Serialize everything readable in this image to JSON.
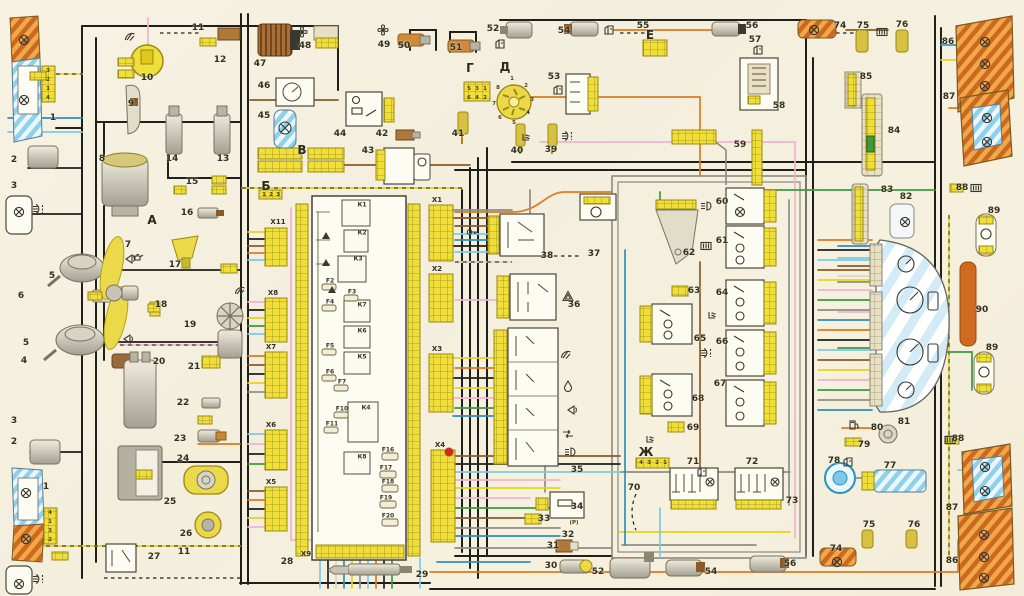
{
  "meta": {
    "type": "automotive-wiring-diagram",
    "language": "Russian",
    "numbered_components_range": "1-90"
  },
  "palette": {
    "background": "#f6f0df",
    "connector_yellow": "#f0df3a",
    "connector_border": "#9a8a10",
    "headlight_blue_hatch": "#8fd0ea",
    "tail_lamp_orange": "#f0a848",
    "tail_lamp_orange_dark": "#cc6820",
    "wire_black": "#1f1f1c",
    "wire_pink": "#efb3cf",
    "wire_orange": "#de7a1c",
    "wire_yellow": "#e6d31f",
    "wire_blue": "#2e8fc0",
    "wire_lightblue": "#7cc9e8",
    "wire_green": "#3c9a3f",
    "wire_brown": "#8a5a28",
    "wire_gray": "#8e8e84",
    "metal": "#c9c4b2",
    "block_fill": "#fdfcf2",
    "marker_red": "#cc2a22"
  },
  "labels": {
    "numbers": [
      {
        "t": "1",
        "x": 53,
        "y": 118
      },
      {
        "t": "2",
        "x": 14,
        "y": 160
      },
      {
        "t": "3",
        "x": 14,
        "y": 186
      },
      {
        "t": "4",
        "x": 24,
        "y": 361
      },
      {
        "t": "5",
        "x": 52,
        "y": 276
      },
      {
        "t": "5",
        "x": 26,
        "y": 343
      },
      {
        "t": "6",
        "x": 21,
        "y": 296
      },
      {
        "t": "7",
        "x": 128,
        "y": 245
      },
      {
        "t": "8",
        "x": 102,
        "y": 159
      },
      {
        "t": "9",
        "x": 131,
        "y": 104
      },
      {
        "t": "10",
        "x": 147,
        "y": 78
      },
      {
        "t": "11",
        "x": 198,
        "y": 28
      },
      {
        "t": "12",
        "x": 220,
        "y": 60
      },
      {
        "t": "13",
        "x": 223,
        "y": 159
      },
      {
        "t": "14",
        "x": 172,
        "y": 159
      },
      {
        "t": "15",
        "x": 192,
        "y": 182
      },
      {
        "t": "16",
        "x": 187,
        "y": 213
      },
      {
        "t": "17",
        "x": 175,
        "y": 265
      },
      {
        "t": "18",
        "x": 161,
        "y": 305
      },
      {
        "t": "19",
        "x": 190,
        "y": 325
      },
      {
        "t": "20",
        "x": 159,
        "y": 362
      },
      {
        "t": "21",
        "x": 194,
        "y": 367
      },
      {
        "t": "22",
        "x": 183,
        "y": 403
      },
      {
        "t": "23",
        "x": 180,
        "y": 439
      },
      {
        "t": "24",
        "x": 183,
        "y": 459
      },
      {
        "t": "25",
        "x": 170,
        "y": 502
      },
      {
        "t": "26",
        "x": 186,
        "y": 534
      },
      {
        "t": "27",
        "x": 154,
        "y": 557
      },
      {
        "t": "1",
        "x": 46,
        "y": 487
      },
      {
        "t": "2",
        "x": 14,
        "y": 442
      },
      {
        "t": "3",
        "x": 14,
        "y": 421
      },
      {
        "t": "11",
        "x": 184,
        "y": 552
      },
      {
        "t": "28",
        "x": 287,
        "y": 562
      },
      {
        "t": "29",
        "x": 422,
        "y": 575
      },
      {
        "t": "30",
        "x": 551,
        "y": 566
      },
      {
        "t": "31",
        "x": 553,
        "y": 546
      },
      {
        "t": "32",
        "x": 568,
        "y": 535
      },
      {
        "t": "33",
        "x": 544,
        "y": 519
      },
      {
        "t": "34",
        "x": 577,
        "y": 507
      },
      {
        "t": "35",
        "x": 577,
        "y": 470
      },
      {
        "t": "36",
        "x": 574,
        "y": 305
      },
      {
        "t": "37",
        "x": 594,
        "y": 254
      },
      {
        "t": "38",
        "x": 547,
        "y": 256
      },
      {
        "t": "39",
        "x": 551,
        "y": 150
      },
      {
        "t": "40",
        "x": 517,
        "y": 151
      },
      {
        "t": "41",
        "x": 458,
        "y": 134
      },
      {
        "t": "42",
        "x": 382,
        "y": 134
      },
      {
        "t": "43",
        "x": 368,
        "y": 151
      },
      {
        "t": "44",
        "x": 340,
        "y": 134
      },
      {
        "t": "45",
        "x": 264,
        "y": 116
      },
      {
        "t": "46",
        "x": 264,
        "y": 86
      },
      {
        "t": "47",
        "x": 260,
        "y": 64
      },
      {
        "t": "48",
        "x": 305,
        "y": 46
      },
      {
        "t": "49",
        "x": 384,
        "y": 45
      },
      {
        "t": "50",
        "x": 404,
        "y": 46
      },
      {
        "t": "51",
        "x": 456,
        "y": 48
      },
      {
        "t": "52",
        "x": 493,
        "y": 29
      },
      {
        "t": "53",
        "x": 554,
        "y": 77
      },
      {
        "t": "54",
        "x": 564,
        "y": 31
      },
      {
        "t": "55",
        "x": 643,
        "y": 26
      },
      {
        "t": "56",
        "x": 752,
        "y": 26
      },
      {
        "t": "57",
        "x": 755,
        "y": 40
      },
      {
        "t": "58",
        "x": 779,
        "y": 106
      },
      {
        "t": "59",
        "x": 740,
        "y": 145
      },
      {
        "t": "60",
        "x": 722,
        "y": 202
      },
      {
        "t": "61",
        "x": 722,
        "y": 241
      },
      {
        "t": "62",
        "x": 689,
        "y": 253
      },
      {
        "t": "63",
        "x": 694,
        "y": 291
      },
      {
        "t": "64",
        "x": 722,
        "y": 293
      },
      {
        "t": "65",
        "x": 700,
        "y": 339
      },
      {
        "t": "66",
        "x": 722,
        "y": 342
      },
      {
        "t": "67",
        "x": 720,
        "y": 384
      },
      {
        "t": "68",
        "x": 698,
        "y": 399
      },
      {
        "t": "69",
        "x": 693,
        "y": 428
      },
      {
        "t": "70",
        "x": 634,
        "y": 488
      },
      {
        "t": "71",
        "x": 693,
        "y": 462
      },
      {
        "t": "72",
        "x": 752,
        "y": 462
      },
      {
        "t": "73",
        "x": 792,
        "y": 501
      },
      {
        "t": "74",
        "x": 840,
        "y": 26
      },
      {
        "t": "75",
        "x": 863,
        "y": 26
      },
      {
        "t": "76",
        "x": 902,
        "y": 25
      },
      {
        "t": "77",
        "x": 890,
        "y": 466
      },
      {
        "t": "78",
        "x": 834,
        "y": 461
      },
      {
        "t": "79",
        "x": 864,
        "y": 445
      },
      {
        "t": "80",
        "x": 877,
        "y": 428
      },
      {
        "t": "81",
        "x": 904,
        "y": 422
      },
      {
        "t": "82",
        "x": 906,
        "y": 197
      },
      {
        "t": "83",
        "x": 887,
        "y": 190
      },
      {
        "t": "84",
        "x": 894,
        "y": 131
      },
      {
        "t": "85",
        "x": 866,
        "y": 77
      },
      {
        "t": "86",
        "x": 948,
        "y": 42
      },
      {
        "t": "87",
        "x": 949,
        "y": 97
      },
      {
        "t": "88",
        "x": 962,
        "y": 188
      },
      {
        "t": "89",
        "x": 994,
        "y": 211
      },
      {
        "t": "90",
        "x": 982,
        "y": 310
      },
      {
        "t": "89",
        "x": 992,
        "y": 348
      },
      {
        "t": "88",
        "x": 958,
        "y": 439
      },
      {
        "t": "87",
        "x": 952,
        "y": 508
      },
      {
        "t": "86",
        "x": 952,
        "y": 561
      },
      {
        "t": "74",
        "x": 836,
        "y": 549
      },
      {
        "t": "75",
        "x": 869,
        "y": 525
      },
      {
        "t": "76",
        "x": 914,
        "y": 525
      },
      {
        "t": "52",
        "x": 598,
        "y": 572
      },
      {
        "t": "54",
        "x": 711,
        "y": 572
      },
      {
        "t": "56",
        "x": 790,
        "y": 564
      }
    ],
    "letters": [
      {
        "t": "А",
        "x": 152,
        "y": 220
      },
      {
        "t": "Б",
        "x": 266,
        "y": 186
      },
      {
        "t": "В",
        "x": 302,
        "y": 150
      },
      {
        "t": "Г",
        "x": 470,
        "y": 68
      },
      {
        "t": "Д",
        "x": 505,
        "y": 67
      },
      {
        "t": "Е",
        "x": 650,
        "y": 35
      },
      {
        "t": "Ж",
        "x": 646,
        "y": 452
      }
    ],
    "relays": [
      {
        "t": "К1",
        "x": 362,
        "y": 205
      },
      {
        "t": "К2",
        "x": 362,
        "y": 233
      },
      {
        "t": "К3",
        "x": 358,
        "y": 259
      },
      {
        "t": "К7",
        "x": 362,
        "y": 305
      },
      {
        "t": "К6",
        "x": 362,
        "y": 331
      },
      {
        "t": "К5",
        "x": 362,
        "y": 357
      },
      {
        "t": "К4",
        "x": 366,
        "y": 408
      },
      {
        "t": "К8",
        "x": 362,
        "y": 457
      }
    ],
    "fuses": [
      {
        "t": "F2",
        "x": 330,
        "y": 281
      },
      {
        "t": "F3",
        "x": 352,
        "y": 292
      },
      {
        "t": "F4",
        "x": 330,
        "y": 302
      },
      {
        "t": "F5",
        "x": 330,
        "y": 346
      },
      {
        "t": "F6",
        "x": 330,
        "y": 372
      },
      {
        "t": "F7",
        "x": 342,
        "y": 382
      },
      {
        "t": "F10",
        "x": 342,
        "y": 409
      },
      {
        "t": "F11",
        "x": 332,
        "y": 424
      },
      {
        "t": "F16",
        "x": 388,
        "y": 450
      },
      {
        "t": "F17",
        "x": 386,
        "y": 468
      },
      {
        "t": "F18",
        "x": 388,
        "y": 482
      },
      {
        "t": "F19",
        "x": 386,
        "y": 498
      },
      {
        "t": "F20",
        "x": 388,
        "y": 516
      }
    ],
    "connectors": [
      {
        "t": "Х11",
        "x": 278,
        "y": 222
      },
      {
        "t": "Х8",
        "x": 273,
        "y": 293
      },
      {
        "t": "Х7",
        "x": 271,
        "y": 347
      },
      {
        "t": "Х6",
        "x": 271,
        "y": 425
      },
      {
        "t": "Х5",
        "x": 271,
        "y": 482
      },
      {
        "t": "Х1",
        "x": 437,
        "y": 200
      },
      {
        "t": "Х2",
        "x": 437,
        "y": 269
      },
      {
        "t": "Х3",
        "x": 437,
        "y": 349
      },
      {
        "t": "Х4",
        "x": 440,
        "y": 445
      },
      {
        "t": "Х9",
        "x": 306,
        "y": 554
      }
    ],
    "pins": [
      {
        "t": "3",
        "x": 48,
        "y": 71
      },
      {
        "t": "2",
        "x": 48,
        "y": 80
      },
      {
        "t": "1",
        "x": 48,
        "y": 89
      },
      {
        "t": "4",
        "x": 48,
        "y": 98
      },
      {
        "t": "4",
        "x": 50,
        "y": 513
      },
      {
        "t": "1",
        "x": 50,
        "y": 522
      },
      {
        "t": "3",
        "x": 50,
        "y": 531
      },
      {
        "t": "2",
        "x": 50,
        "y": 540
      },
      {
        "t": "5",
        "x": 469,
        "y": 89
      },
      {
        "t": "3",
        "x": 477,
        "y": 89
      },
      {
        "t": "1",
        "x": 485,
        "y": 89
      },
      {
        "t": "6",
        "x": 469,
        "y": 98
      },
      {
        "t": "4",
        "x": 477,
        "y": 98
      },
      {
        "t": "2",
        "x": 485,
        "y": 98
      },
      {
        "t": "1",
        "x": 512,
        "y": 79
      },
      {
        "t": "2",
        "x": 526,
        "y": 86
      },
      {
        "t": "3",
        "x": 532,
        "y": 100
      },
      {
        "t": "4",
        "x": 528,
        "y": 113
      },
      {
        "t": "5",
        "x": 514,
        "y": 123
      },
      {
        "t": "6",
        "x": 500,
        "y": 118
      },
      {
        "t": "7",
        "x": 494,
        "y": 104
      },
      {
        "t": "8",
        "x": 498,
        "y": 88
      },
      {
        "t": "4",
        "x": 641,
        "y": 463
      },
      {
        "t": "3",
        "x": 649,
        "y": 463
      },
      {
        "t": "2",
        "x": 657,
        "y": 463
      },
      {
        "t": "1",
        "x": 665,
        "y": 463
      },
      {
        "t": "1",
        "x": 264,
        "y": 195
      },
      {
        "t": "2",
        "x": 271,
        "y": 195
      },
      {
        "t": "3",
        "x": 278,
        "y": 195
      },
      {
        "t": "(P)",
        "x": 574,
        "y": 523
      }
    ]
  },
  "icons": [
    {
      "type": "lamp",
      "x": 18,
      "y": 34
    },
    {
      "type": "lamp",
      "x": 18,
      "y": 94
    },
    {
      "type": "lamp",
      "x": 20,
      "y": 487
    },
    {
      "type": "lamp",
      "x": 20,
      "y": 533
    },
    {
      "type": "lamp",
      "x": 13,
      "y": 206
    },
    {
      "type": "lamp",
      "x": 13,
      "y": 578
    },
    {
      "type": "lamp",
      "x": 899,
      "y": 216
    },
    {
      "type": "lamp",
      "x": 979,
      "y": 36
    },
    {
      "type": "lamp",
      "x": 979,
      "y": 58
    },
    {
      "type": "lamp",
      "x": 979,
      "y": 80
    },
    {
      "type": "lamp",
      "x": 981,
      "y": 112
    },
    {
      "type": "lamp",
      "x": 981,
      "y": 136
    },
    {
      "type": "lamp",
      "x": 979,
      "y": 461
    },
    {
      "type": "lamp",
      "x": 979,
      "y": 485
    },
    {
      "type": "lamp",
      "x": 978,
      "y": 529
    },
    {
      "type": "lamp",
      "x": 978,
      "y": 551
    },
    {
      "type": "lamp",
      "x": 978,
      "y": 572
    },
    {
      "type": "lamp",
      "x": 808,
      "y": 24
    },
    {
      "type": "lamp",
      "x": 831,
      "y": 556
    },
    {
      "type": "fog",
      "x": 32,
      "y": 203
    },
    {
      "type": "fog",
      "x": 32,
      "y": 573
    },
    {
      "type": "fog",
      "x": 561,
      "y": 130
    },
    {
      "type": "fog",
      "x": 700,
      "y": 347
    },
    {
      "type": "horn",
      "x": 124,
      "y": 252
    },
    {
      "type": "horn",
      "x": 122,
      "y": 332
    },
    {
      "type": "horn",
      "x": 566,
      "y": 403
    },
    {
      "type": "wiper",
      "x": 124,
      "y": 30
    },
    {
      "type": "wiper",
      "x": 560,
      "y": 348
    },
    {
      "type": "wiper",
      "x": 234,
      "y": 284
    },
    {
      "type": "droplet",
      "x": 562,
      "y": 380
    },
    {
      "type": "seatheat",
      "x": 520,
      "y": 132
    },
    {
      "type": "seatheat",
      "x": 706,
      "y": 310
    },
    {
      "type": "seatheat",
      "x": 644,
      "y": 434
    },
    {
      "type": "fan4",
      "x": 296,
      "y": 26
    },
    {
      "type": "fan4",
      "x": 377,
      "y": 24
    },
    {
      "type": "key",
      "x": 466,
      "y": 226
    },
    {
      "type": "door",
      "x": 494,
      "y": 38
    },
    {
      "type": "door",
      "x": 552,
      "y": 84
    },
    {
      "type": "door",
      "x": 603,
      "y": 24
    },
    {
      "type": "door",
      "x": 752,
      "y": 44
    },
    {
      "type": "door",
      "x": 696,
      "y": 466
    },
    {
      "type": "door",
      "x": 842,
      "y": 456
    },
    {
      "type": "warntri",
      "x": 562,
      "y": 290
    },
    {
      "type": "grille",
      "x": 970,
      "y": 182
    },
    {
      "type": "grille",
      "x": 944,
      "y": 434
    },
    {
      "type": "grille",
      "x": 700,
      "y": 240
    },
    {
      "type": "grille",
      "x": 876,
      "y": 26
    },
    {
      "type": "headlamp",
      "x": 564,
      "y": 446
    },
    {
      "type": "headlamp",
      "x": 700,
      "y": 200
    },
    {
      "type": "arrows",
      "x": 562,
      "y": 428
    },
    {
      "type": "oilcan",
      "x": 132,
      "y": 250
    },
    {
      "type": "fuelpump",
      "x": 848,
      "y": 418
    }
  ],
  "mini_connectors": [
    {
      "x": 42,
      "y": 66,
      "w": 13,
      "h": 36
    },
    {
      "x": 44,
      "y": 508,
      "w": 13,
      "h": 36
    },
    {
      "x": 118,
      "y": 58,
      "w": 16,
      "h": 8
    },
    {
      "x": 118,
      "y": 70,
      "w": 16,
      "h": 8
    },
    {
      "x": 200,
      "y": 38,
      "w": 16,
      "h": 8
    },
    {
      "x": 212,
      "y": 176,
      "w": 14,
      "h": 8
    },
    {
      "x": 212,
      "y": 186,
      "w": 14,
      "h": 8
    },
    {
      "x": 174,
      "y": 186,
      "w": 12,
      "h": 8
    },
    {
      "x": 221,
      "y": 264,
      "w": 16,
      "h": 9
    },
    {
      "x": 148,
      "y": 304,
      "w": 12,
      "h": 8
    },
    {
      "x": 202,
      "y": 356,
      "w": 18,
      "h": 12
    },
    {
      "x": 136,
      "y": 470,
      "w": 16,
      "h": 9
    },
    {
      "x": 30,
      "y": 72,
      "w": 16,
      "h": 8
    },
    {
      "x": 52,
      "y": 552,
      "w": 16,
      "h": 8
    },
    {
      "x": 88,
      "y": 292,
      "w": 14,
      "h": 8
    },
    {
      "x": 198,
      "y": 416,
      "w": 14,
      "h": 8
    },
    {
      "x": 464,
      "y": 82,
      "w": 26,
      "h": 19
    },
    {
      "x": 636,
      "y": 458,
      "w": 33,
      "h": 10
    },
    {
      "x": 259,
      "y": 190,
      "w": 23,
      "h": 9
    },
    {
      "x": 656,
      "y": 200,
      "w": 40,
      "h": 9
    },
    {
      "x": 672,
      "y": 286,
      "w": 16,
      "h": 10
    },
    {
      "x": 668,
      "y": 422,
      "w": 16,
      "h": 10
    },
    {
      "x": 671,
      "y": 500,
      "w": 45,
      "h": 9
    },
    {
      "x": 736,
      "y": 500,
      "w": 45,
      "h": 9
    },
    {
      "x": 845,
      "y": 438,
      "w": 16,
      "h": 8
    },
    {
      "x": 950,
      "y": 184,
      "w": 13,
      "h": 8
    },
    {
      "x": 946,
      "y": 436,
      "w": 13,
      "h": 8
    },
    {
      "x": 525,
      "y": 514,
      "w": 16,
      "h": 10
    },
    {
      "x": 536,
      "y": 498,
      "w": 12,
      "h": 12
    },
    {
      "x": 672,
      "y": 130,
      "w": 44,
      "h": 14
    },
    {
      "x": 643,
      "y": 40,
      "w": 24,
      "h": 16
    },
    {
      "x": 316,
      "y": 38,
      "w": 22,
      "h": 10
    }
  ]
}
